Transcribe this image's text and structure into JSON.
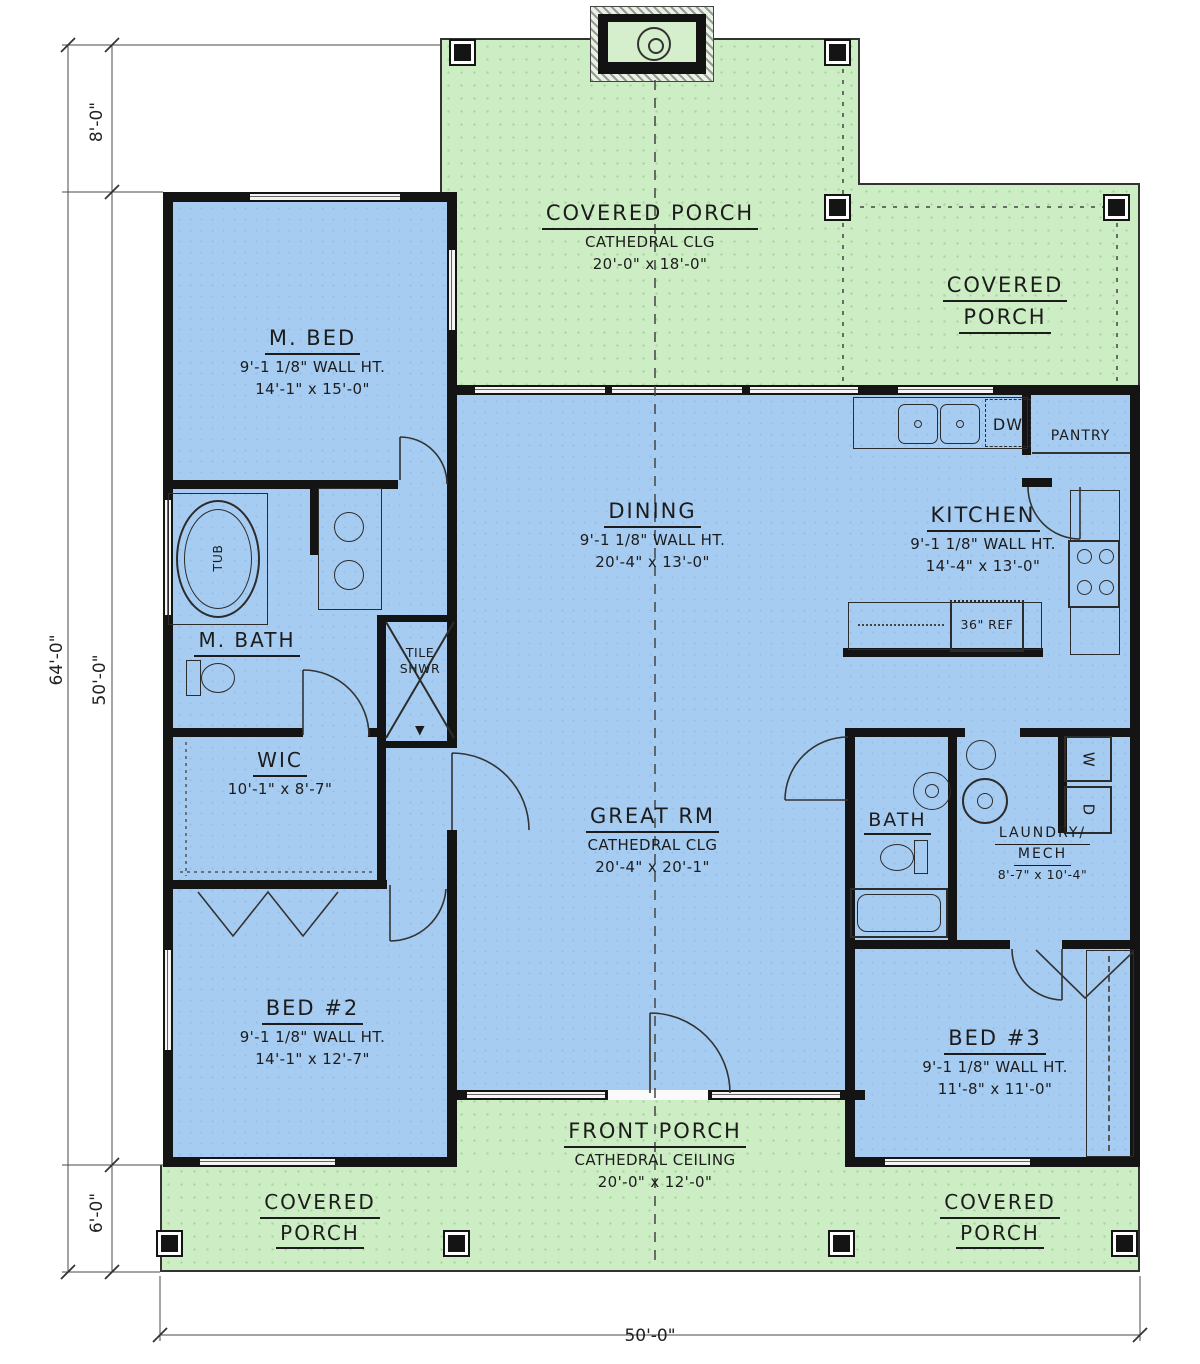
{
  "colors": {
    "porch_green": "#cdeec4",
    "interior_blue": "#a7ccf2",
    "wall_black": "#141414",
    "dim_line": "#4a4a4a"
  },
  "dimensions": {
    "overall_height": "64'-0\"",
    "top_offset": "8'-0\"",
    "house_depth": "50'-0\"",
    "bottom_offset": "6'-0\"",
    "overall_width": "50'-0\""
  },
  "rooms": {
    "porch_top": {
      "name": "COVERED PORCH",
      "ceiling": "CATHEDRAL CLG",
      "size": "20'-0\" x 18'-0\""
    },
    "porch_top_right": {
      "name1": "COVERED",
      "name2": "PORCH"
    },
    "m_bed": {
      "name": "M. BED",
      "wall_ht": "9'-1 1/8\" WALL HT.",
      "size": "14'-1\" x 15'-0\""
    },
    "dining": {
      "name": "DINING",
      "wall_ht": "9'-1 1/8\" WALL HT.",
      "size": "20'-4\" x 13'-0\""
    },
    "kitchen": {
      "name": "KITCHEN",
      "wall_ht": "9'-1 1/8\" WALL HT.",
      "size": "14'-4\" x 13'-0\""
    },
    "m_bath": {
      "name": "M. BATH"
    },
    "tile_shower": {
      "name1": "TILE",
      "name2": "SHWR"
    },
    "tub": {
      "name": "TUB"
    },
    "wic": {
      "name": "WIC",
      "size": "10'-1\" x 8'-7\""
    },
    "great_room": {
      "name": "GREAT RM",
      "ceiling": "CATHEDRAL CLG",
      "size": "20'-4\" x 20'-1\""
    },
    "bath2": {
      "name": "BATH"
    },
    "laundry": {
      "name1": "LAUNDRY/",
      "name2": "MECH",
      "size": "8'-7\" x 10'-4\""
    },
    "bed2": {
      "name": "BED #2",
      "wall_ht": "9'-1 1/8\" WALL HT.",
      "size": "14'-1\" x 12'-7\""
    },
    "bed3": {
      "name": "BED #3",
      "wall_ht": "9'-1 1/8\" WALL HT.",
      "size": "11'-8\" x 11'-0\""
    },
    "front_porch": {
      "name": "FRONT PORCH",
      "ceiling": "CATHEDRAL CEILING",
      "size": "20'-0\" x 12'-0\""
    },
    "porch_bottom_left": {
      "name1": "COVERED",
      "name2": "PORCH"
    },
    "porch_bottom_right": {
      "name1": "COVERED",
      "name2": "PORCH"
    }
  },
  "fixtures": {
    "dw": "DW",
    "pantry": "PANTRY",
    "ref": "36\" REF",
    "washer": "W",
    "dryer": "D",
    "shower_mark": "▼"
  }
}
